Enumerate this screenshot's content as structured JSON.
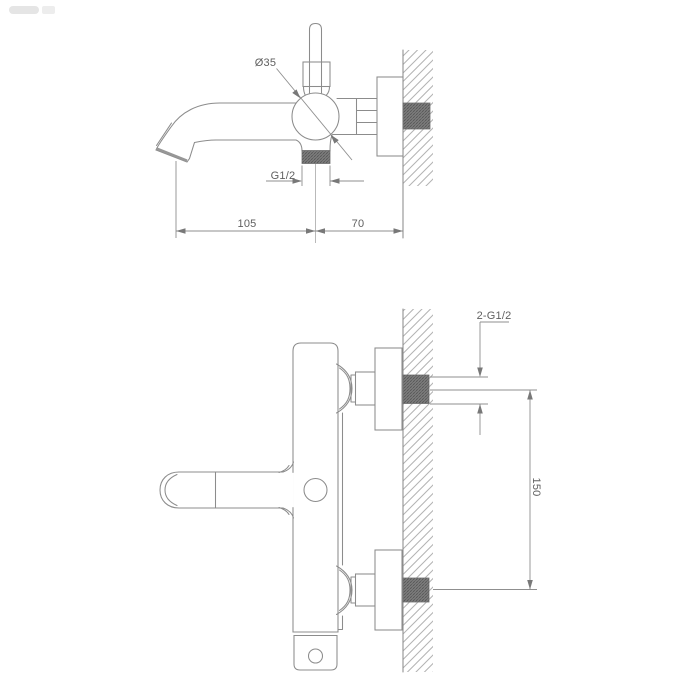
{
  "drawing": {
    "title_semantic": "wall-mounted bath mixer technical drawing, side view and front view",
    "colors": {
      "background": "#ffffff",
      "outline": "#8c8c8c",
      "dimension_line": "#8f8f8f",
      "text": "#5f5f5f",
      "hatch": "#b3b3b3",
      "knurl_base": "#848484",
      "arrow_fill": "#787878"
    },
    "top_view": {
      "diameter_label": "Ø35",
      "outlet_thread_label": "G1/2",
      "dim_spout_projection": "105",
      "dim_wall_offset": "70"
    },
    "bottom_view": {
      "connection_thread_label": "2-G1/2",
      "dim_connection_spacing": "150"
    }
  }
}
